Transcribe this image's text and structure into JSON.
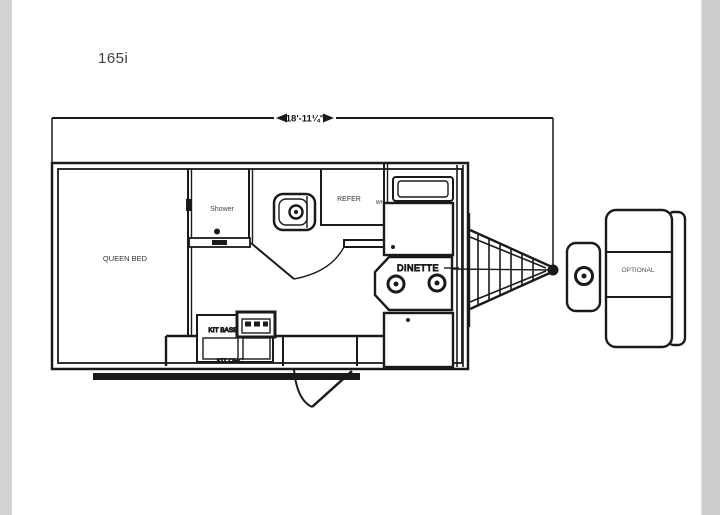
{
  "header": {
    "model": "165i"
  },
  "dimension": {
    "overall_length": "18'-11¼\""
  },
  "floorplan": {
    "type": "travel-trailer-floorplan",
    "labels": {
      "queen_bed": "QUEEN BED",
      "shower": "Shower",
      "refer": "REFER",
      "water_heater": "WH",
      "dinette": "DINETTE",
      "kit_base": "KIT BASE",
      "kit_ohc": "KIT OHC",
      "optional": "OPTIONAL"
    }
  },
  "colors": {
    "line": "#1a1a1a",
    "label": "#333333",
    "background": "#ffffff",
    "side_strip_left": "#d2d2d2",
    "side_strip_right": "#cccccc"
  }
}
